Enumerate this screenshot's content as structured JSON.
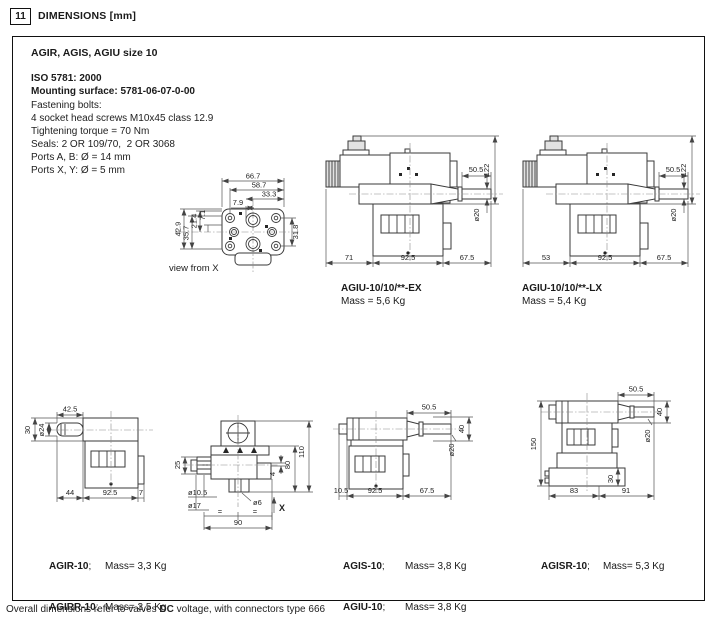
{
  "page": {
    "section_number": "11",
    "section_title": "DIMENSIONS [mm]",
    "footer": {
      "pre": "Overall dimensions refer to valves ",
      "bold": "DC",
      "post": " voltage, with connectors type 666"
    }
  },
  "info": {
    "title": "AGIR, AGIS, AGIU size 10",
    "iso": "ISO 5781: 2000",
    "mounting": "Mounting surface: 5781-06-07-0-00",
    "lines": [
      "Fastening bolts:",
      "4 socket head screws M10x45 class 12.9",
      "Tightening torque = 70 Nm",
      "Seals: 2 OR 109/70,  2 OR 3068",
      "Ports A, B: Ø = 14 mm",
      "Ports X, Y: Ø = 5 mm"
    ]
  },
  "labels": {
    "view_from_x": "view from X",
    "separator": ";"
  },
  "models": {
    "ex": {
      "name": "AGIU-10/10/**-EX",
      "mass": "Mass = 5,6 Kg"
    },
    "lx": {
      "name": "AGIU-10/10/**-LX",
      "mass": "Mass = 5,4 Kg"
    },
    "agir": {
      "name": "AGIR-10",
      "mass": "Mass= 3,3 Kg"
    },
    "agirr": {
      "name": "AGIRR-10",
      "mass": "Mass= 3,5 Kg"
    },
    "agis": {
      "name": "AGIS-10",
      "mass": "Mass= 3,8 Kg"
    },
    "agiu": {
      "name": "AGIU-10",
      "mass": "Mass= 3,8 Kg"
    },
    "agisr": {
      "name": "AGISR-10",
      "mass": "Mass= 5,3 Kg"
    }
  },
  "dims": {
    "view_x": {
      "w1": "66.7",
      "w2": "58.7",
      "w3": "33.3",
      "w4": "7.9",
      "l1": "21.4",
      "l2": "7.1",
      "l3": "35.7",
      "l4": "42.9",
      "r1": "31.8"
    },
    "ex": {
      "top": "50.5",
      "height": "122",
      "dia": "ø20",
      "b1": "71",
      "b2": "92.5",
      "b3": "67.5"
    },
    "lx": {
      "top": "50.5",
      "height": "122",
      "dia": "ø20",
      "b1": "53",
      "b2": "92.5",
      "b3": "67.5"
    },
    "agir": {
      "top": "42.5",
      "l1": "30",
      "l2": "ø24",
      "b1": "44",
      "b2": "92.5",
      "b3": "7"
    },
    "front": {
      "l1": "25",
      "l2": "ø10.5",
      "l3": "ø17",
      "r1": "110",
      "r2": "80",
      "r3": "4",
      "d1": "ø6",
      "b1": "90",
      "eq": "=",
      "x": "X"
    },
    "agis": {
      "top": "50.5",
      "r1": "40",
      "dia": "ø20",
      "b1": "10.5",
      "b2": "92.5",
      "b3": "67.5"
    },
    "agisr": {
      "top": "50.5",
      "r1": "40",
      "dia": "ø20",
      "l1": "150",
      "i1": "30",
      "b1": "83",
      "b2": "91"
    }
  },
  "colors": {
    "line": "#3a3a3a",
    "dim": "#555555",
    "text": "#1a1a1a"
  }
}
